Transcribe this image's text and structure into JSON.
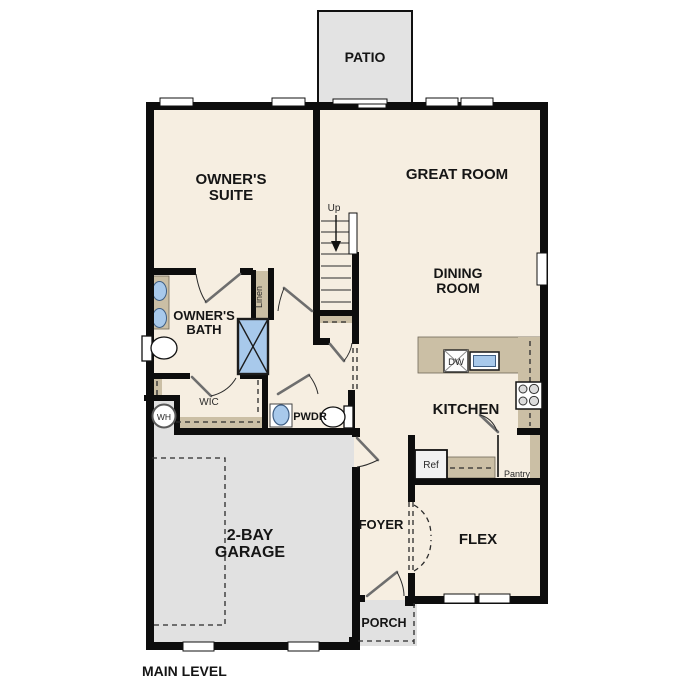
{
  "plan": {
    "title": "MAIN LEVEL",
    "colors": {
      "floor": "#f6eee1",
      "outdoor_concrete": "#e3e3e3",
      "garage_floor": "#e1e1e1",
      "counter_tan": "#cbbfa5",
      "fixture_blue": "#a8c9eb",
      "wall": "#0d0d0d"
    },
    "labels": {
      "patio": "PATIO",
      "owners_suite": [
        "OWNER'S",
        "SUITE"
      ],
      "great_room": "GREAT ROOM",
      "dining_room": [
        "DINING",
        "ROOM"
      ],
      "owners_bath": [
        "OWNER'S",
        "BATH"
      ],
      "linen": "Linen",
      "up": "Up",
      "wic": "WIC",
      "wh": "WH",
      "pwdr": "PWDR",
      "kitchen": "KITCHEN",
      "dw": "DW",
      "ref": "Ref",
      "pantry": "Pantry",
      "garage": [
        "2-BAY",
        "GARAGE"
      ],
      "foyer": "FOYER",
      "flex": "FLEX",
      "porch": "PORCH",
      "main_level": "MAIN LEVEL"
    }
  }
}
